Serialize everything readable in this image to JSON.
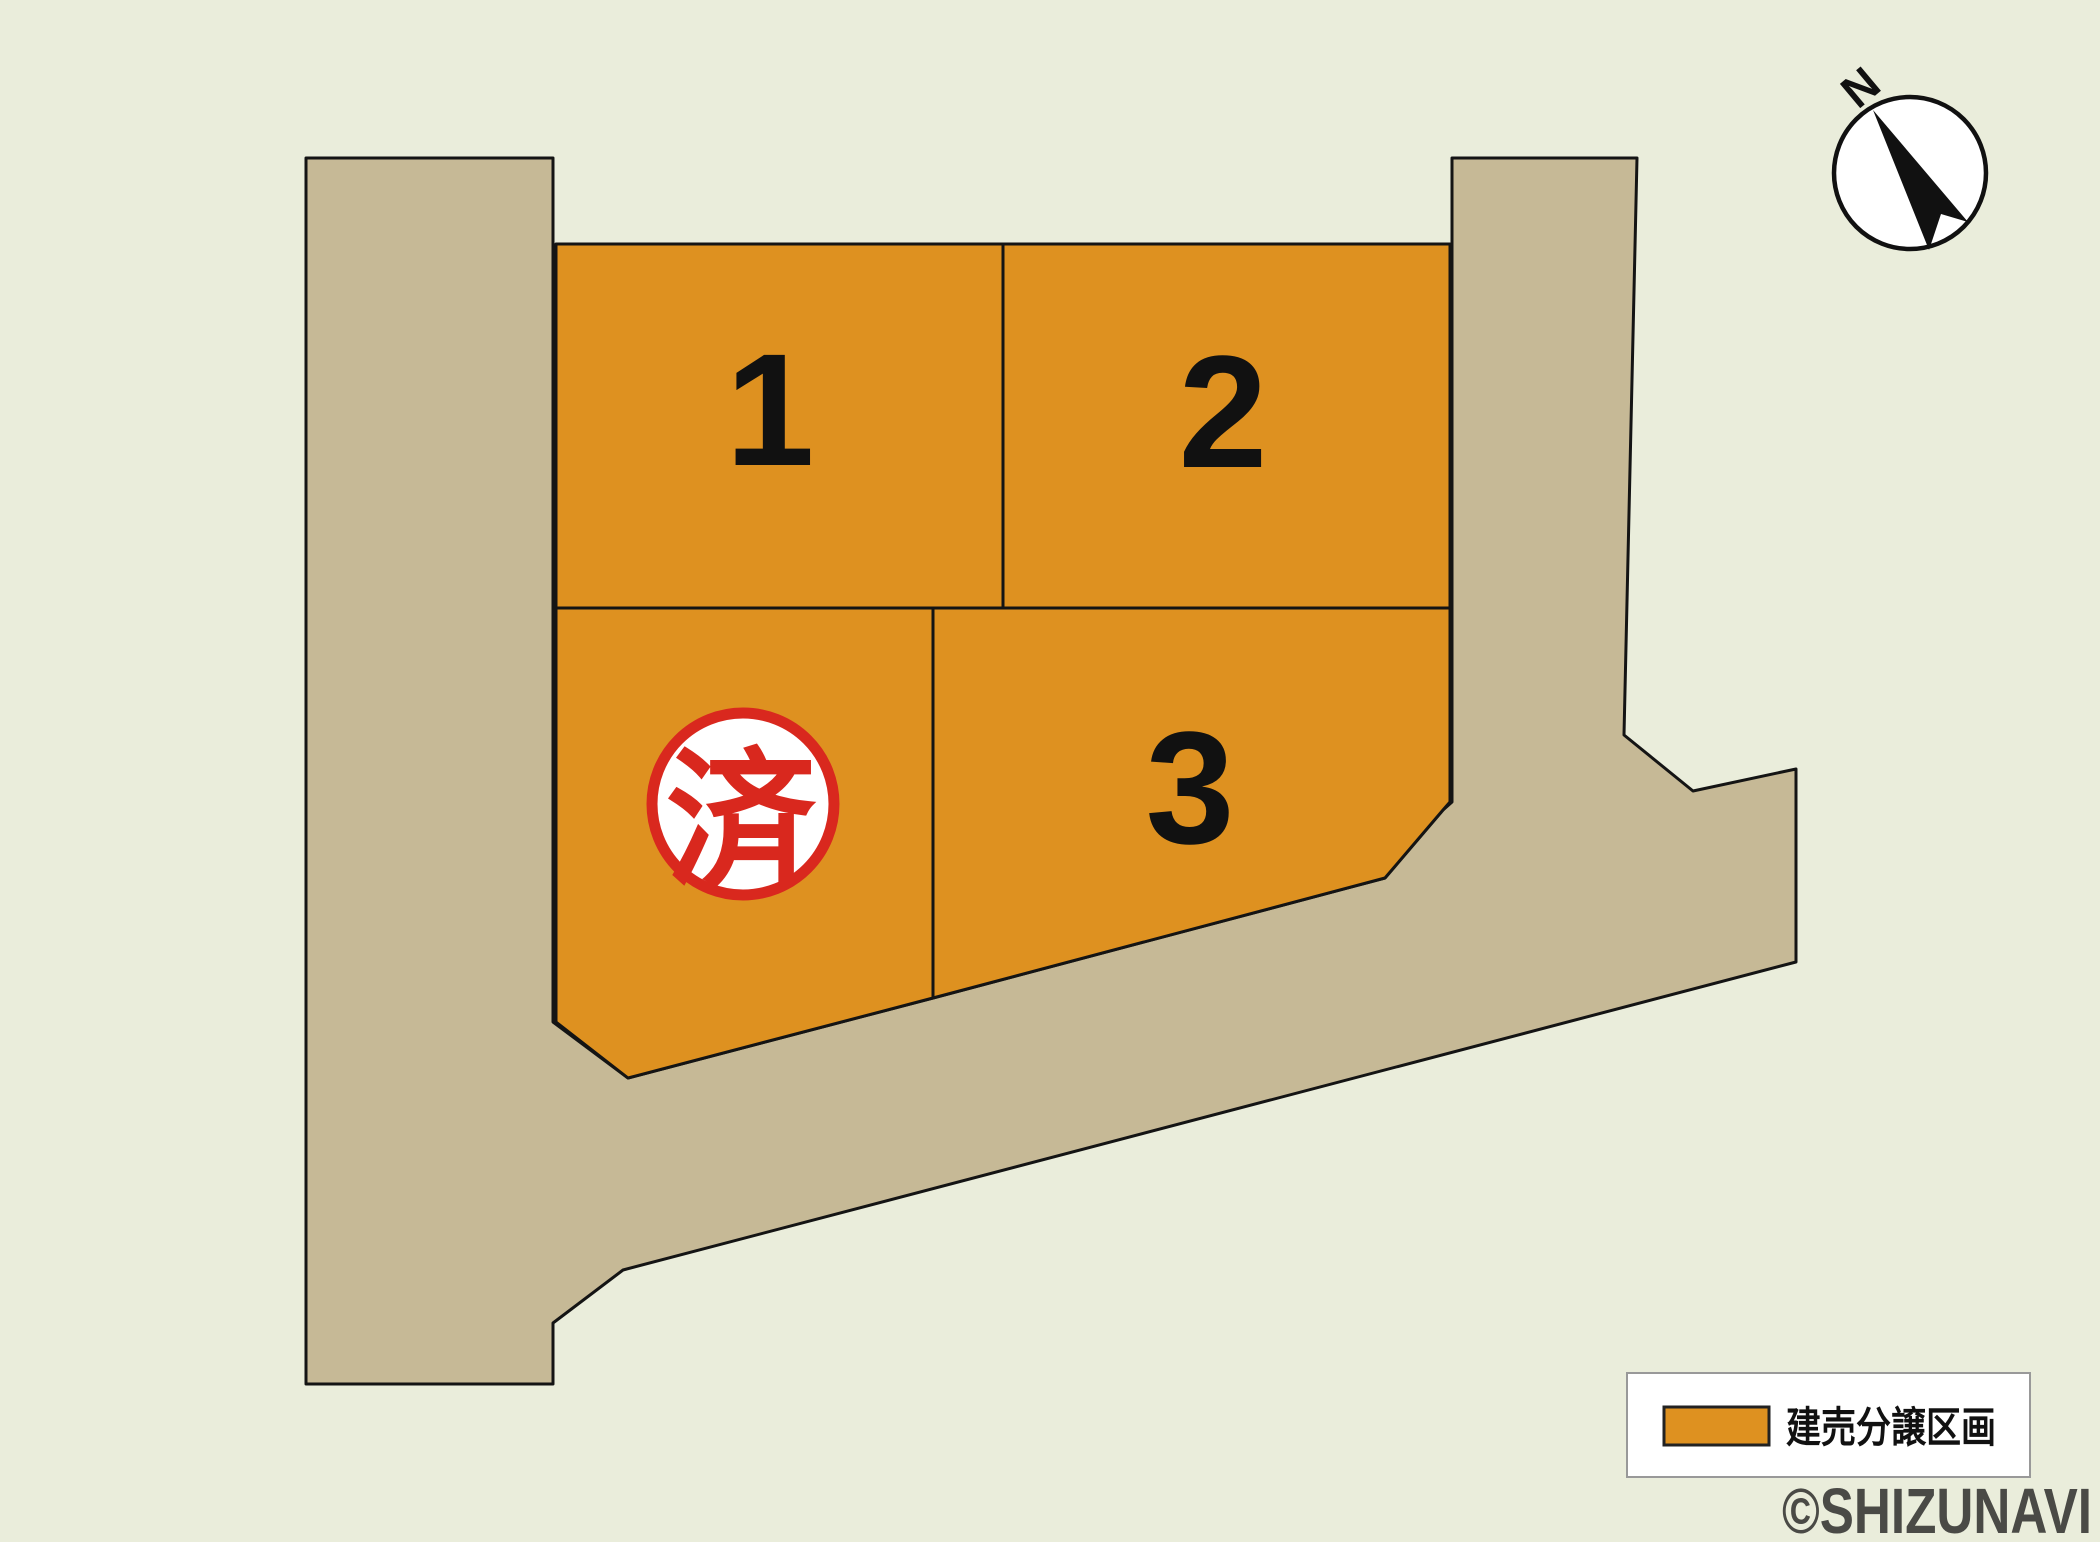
{
  "map": {
    "compass": {
      "label": "N"
    },
    "plots": [
      {
        "number": "1",
        "status": "available"
      },
      {
        "number": "2",
        "status": "available"
      },
      {
        "number": "3",
        "status": "available"
      },
      {
        "number": "",
        "status": "sold",
        "stamp": "済"
      }
    ],
    "legend": {
      "label": "建売分譲区画"
    },
    "watermark": "©SHIZUNAVI"
  },
  "colors": {
    "background": "#eaeddb",
    "road": "#c6b996",
    "plot": "#de9120",
    "outline": "#141414",
    "stamp_red": "#d9281e",
    "watermark_gray": "#4a4a46"
  }
}
